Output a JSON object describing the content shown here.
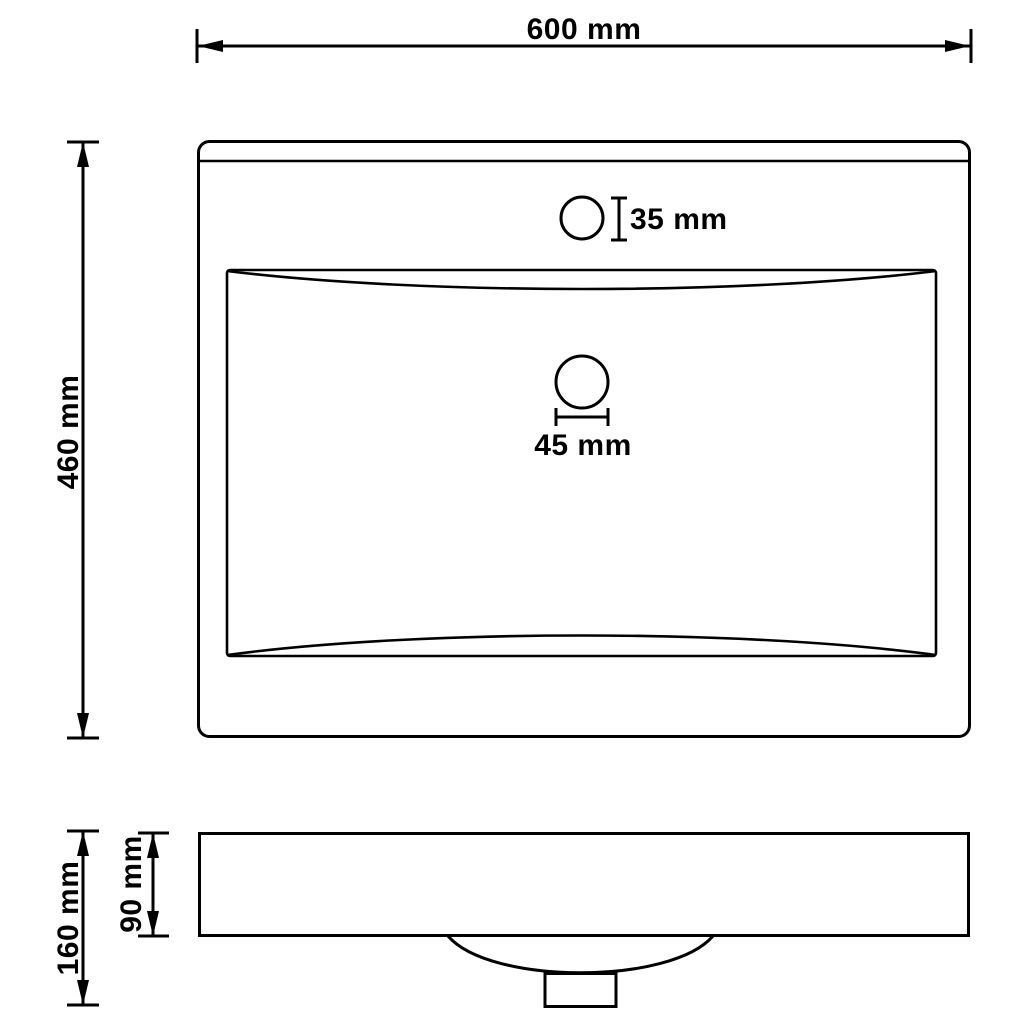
{
  "drawing": {
    "subject": "washbasin-dimension-diagram",
    "views": {
      "top_view": "plan-view-of-basin-with-faucet-and-drain-holes",
      "side_view": "front-section-view-with-bowl-and-drain-stub"
    },
    "labels": {
      "width": "600 mm",
      "depth": "460 mm",
      "faucet_hole": "35 mm",
      "drain_hole": "45 mm",
      "total_height": "160 mm",
      "rim_height": "90 mm"
    },
    "values_mm": {
      "width": 600,
      "depth": 460,
      "faucet_hole_diameter": 35,
      "drain_hole_diameter": 45,
      "total_height": 160,
      "rim_height": 90
    },
    "colors": {
      "line": "#000000",
      "background": "#ffffff"
    }
  }
}
